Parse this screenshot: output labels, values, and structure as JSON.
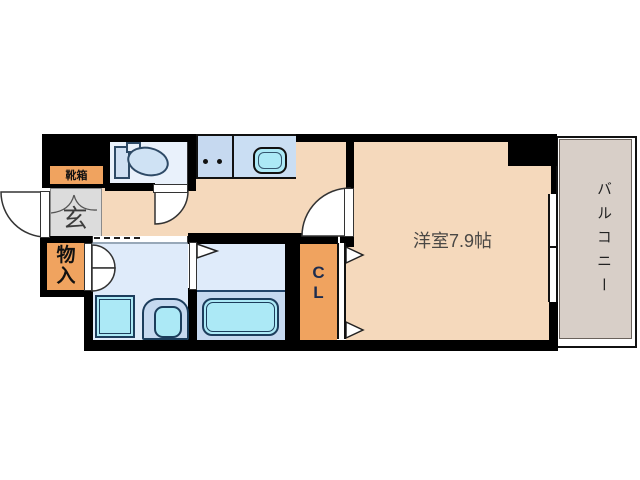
{
  "floorplan": {
    "title": "apartment floor plan",
    "labels": {
      "shoe_box": "靴箱",
      "entrance": "玄",
      "storage_chars": [
        "物",
        "入"
      ],
      "closet_chars": [
        "C",
        "L"
      ],
      "main_room": "洋室7.9帖",
      "balcony": "バルコニー"
    },
    "colors": {
      "wall": "#000000",
      "floor_peach": "#f5d9bc",
      "accent_orange": "#f0a35f",
      "wet_room_blue": "#dfebfa",
      "toilet_room_blue": "#e9f1fb",
      "fixture_blue": "#c6d9f0",
      "water_cyan": "#ace9f6",
      "entrance_gray": "#dcdcdc",
      "balcony_gray": "#d8cfc8"
    }
  }
}
